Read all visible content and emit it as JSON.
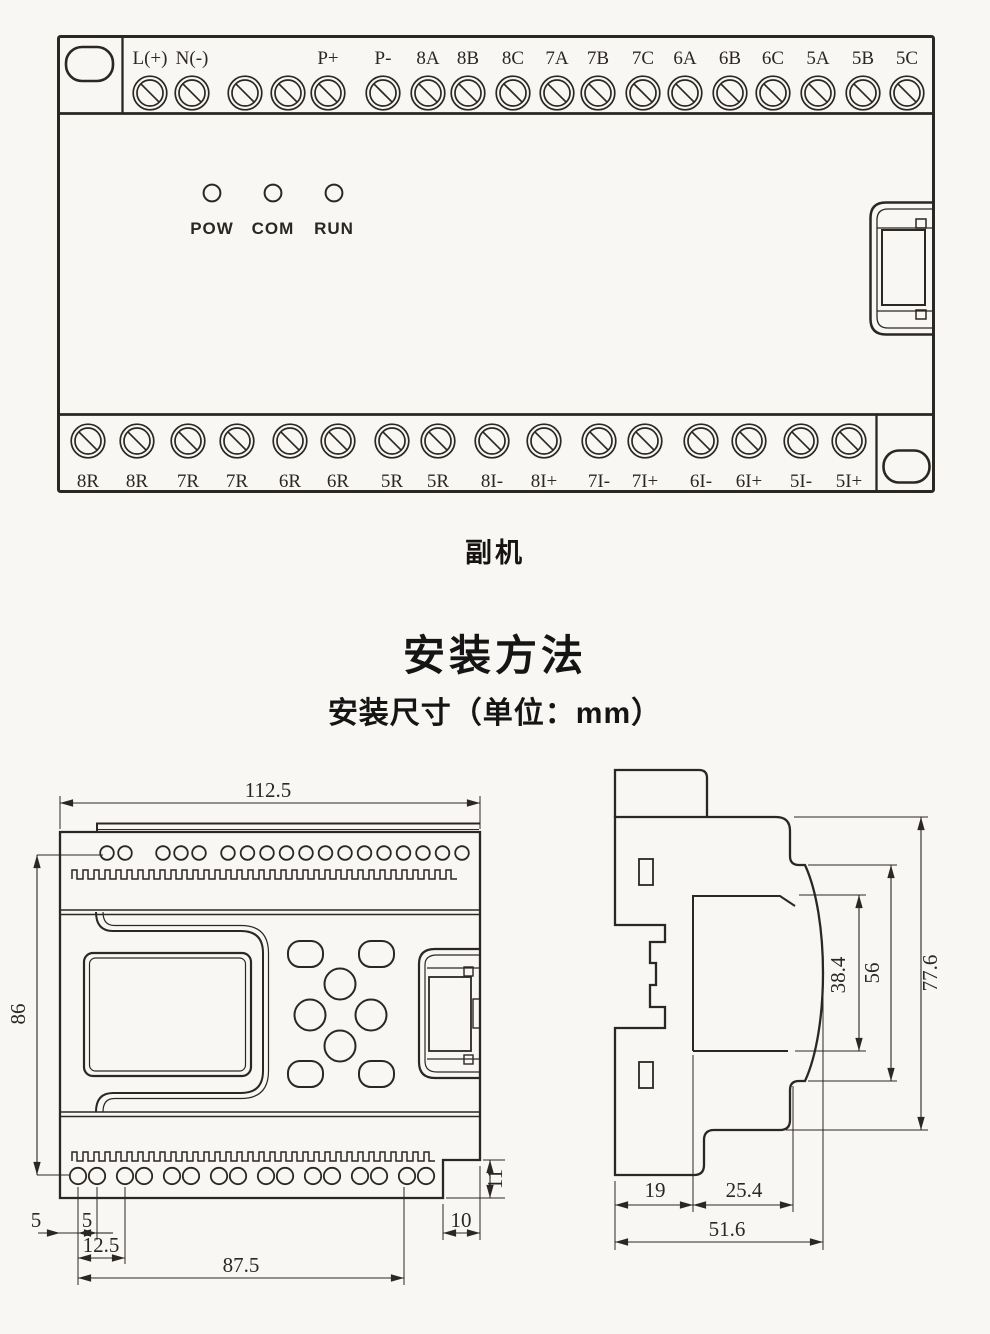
{
  "caption": "副机",
  "installation": {
    "title": "安装方法",
    "subtitle": "安装尺寸（单位：mm）"
  },
  "device": {
    "leds": [
      {
        "label": "POW",
        "x": 212
      },
      {
        "label": "COM",
        "x": 273
      },
      {
        "label": "RUN",
        "x": 334
      }
    ],
    "top_terminals": [
      {
        "label": "L(+)",
        "x": 150
      },
      {
        "label": "N(-)",
        "x": 192
      },
      {
        "label": "",
        "x": 245
      },
      {
        "label": "",
        "x": 288
      },
      {
        "label": "P+",
        "x": 328
      },
      {
        "label": "P-",
        "x": 383
      },
      {
        "label": "8A",
        "x": 428
      },
      {
        "label": "8B",
        "x": 468
      },
      {
        "label": "8C",
        "x": 513
      },
      {
        "label": "7A",
        "x": 557
      },
      {
        "label": "7B",
        "x": 598
      },
      {
        "label": "7C",
        "x": 643
      },
      {
        "label": "6A",
        "x": 685
      },
      {
        "label": "6B",
        "x": 730
      },
      {
        "label": "6C",
        "x": 773
      },
      {
        "label": "5A",
        "x": 818
      },
      {
        "label": "5B",
        "x": 863
      },
      {
        "label": "5C",
        "x": 907
      }
    ],
    "bottom_terminals": [
      {
        "label": "8R",
        "x": 88
      },
      {
        "label": "8R",
        "x": 137
      },
      {
        "label": "7R",
        "x": 188
      },
      {
        "label": "7R",
        "x": 237
      },
      {
        "label": "6R",
        "x": 290
      },
      {
        "label": "6R",
        "x": 338
      },
      {
        "label": "5R",
        "x": 392
      },
      {
        "label": "5R",
        "x": 438
      },
      {
        "label": "8I-",
        "x": 492
      },
      {
        "label": "8I+",
        "x": 544
      },
      {
        "label": "7I-",
        "x": 599
      },
      {
        "label": "7I+",
        "x": 645
      },
      {
        "label": "6I-",
        "x": 701
      },
      {
        "label": "6I+",
        "x": 749
      },
      {
        "label": "5I-",
        "x": 801
      },
      {
        "label": "5I+",
        "x": 849
      }
    ]
  },
  "front_view": {
    "dims": {
      "width": "112.5",
      "height": "86",
      "edge_offset": "5",
      "hole_gap": "5",
      "pair_pitch": "12.5",
      "mount_span": "87.5",
      "notch_width": "10",
      "notch_height": "11"
    }
  },
  "side_view": {
    "dims": {
      "display_depth": "38.4",
      "body_depth": "56",
      "total_depth": "77.6",
      "rail_back": "19",
      "rail_front": "25.4",
      "base_depth": "51.6"
    }
  },
  "colors": {
    "line": "#2b2723",
    "heading": "#151515",
    "background": "#f8f7f4"
  }
}
